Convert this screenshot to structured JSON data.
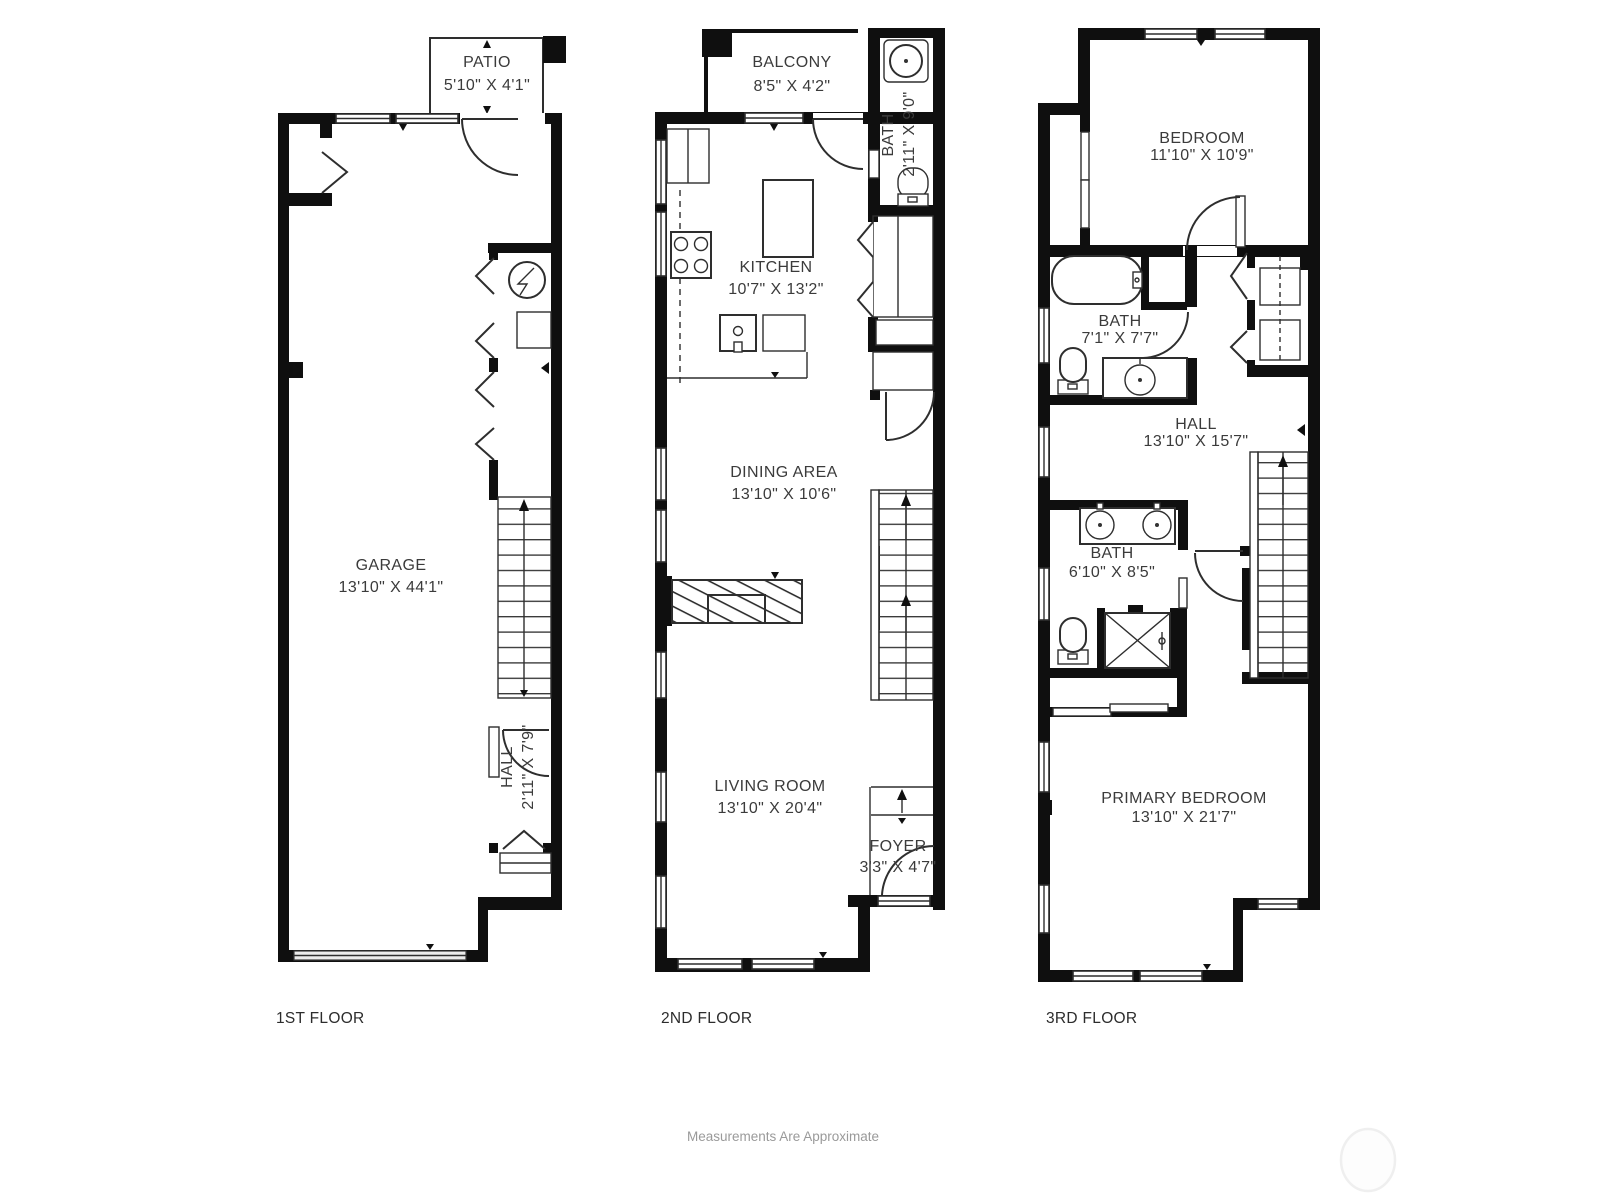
{
  "page": {
    "background": "#ffffff"
  },
  "footer": {
    "disclaimer": "Measurements Are Approximate"
  },
  "floors": {
    "f1": {
      "label": "1ST FLOOR",
      "rooms": {
        "patio": {
          "name": "PATIO",
          "dims": "5'10\" X 4'1\""
        },
        "garage": {
          "name": "GARAGE",
          "dims": "13'10\" X 44'1\""
        },
        "hall": {
          "name": "HALL",
          "dims": "2'11\" X 7'9\""
        }
      }
    },
    "f2": {
      "label": "2ND FLOOR",
      "rooms": {
        "balcony": {
          "name": "BALCONY",
          "dims": "8'5\" X 4'2\""
        },
        "bath": {
          "name": "BATH",
          "dims": "2'11\" X 9'0\""
        },
        "kitchen": {
          "name": "KITCHEN",
          "dims": "10'7\" X 13'2\""
        },
        "dining": {
          "name": "DINING AREA",
          "dims": "13'10\" X 10'6\""
        },
        "living": {
          "name": "LIVING ROOM",
          "dims": "13'10\" X 20'4\""
        },
        "foyer": {
          "name": "FOYER",
          "dims": "3'3\" X 4'7\""
        }
      }
    },
    "f3": {
      "label": "3RD FLOOR",
      "rooms": {
        "bedroom": {
          "name": "BEDROOM",
          "dims": "11'10\" X 10'9\""
        },
        "bath_upper": {
          "name": "BATH",
          "dims": "7'1\" X 7'7\""
        },
        "hall": {
          "name": "HALL",
          "dims": "13'10\" X 15'7\""
        },
        "bath_lower": {
          "name": "BATH",
          "dims": "6'10\" X 8'5\""
        },
        "primary": {
          "name": "PRIMARY BEDROOM",
          "dims": "13'10\" X 21'7\""
        }
      }
    }
  }
}
